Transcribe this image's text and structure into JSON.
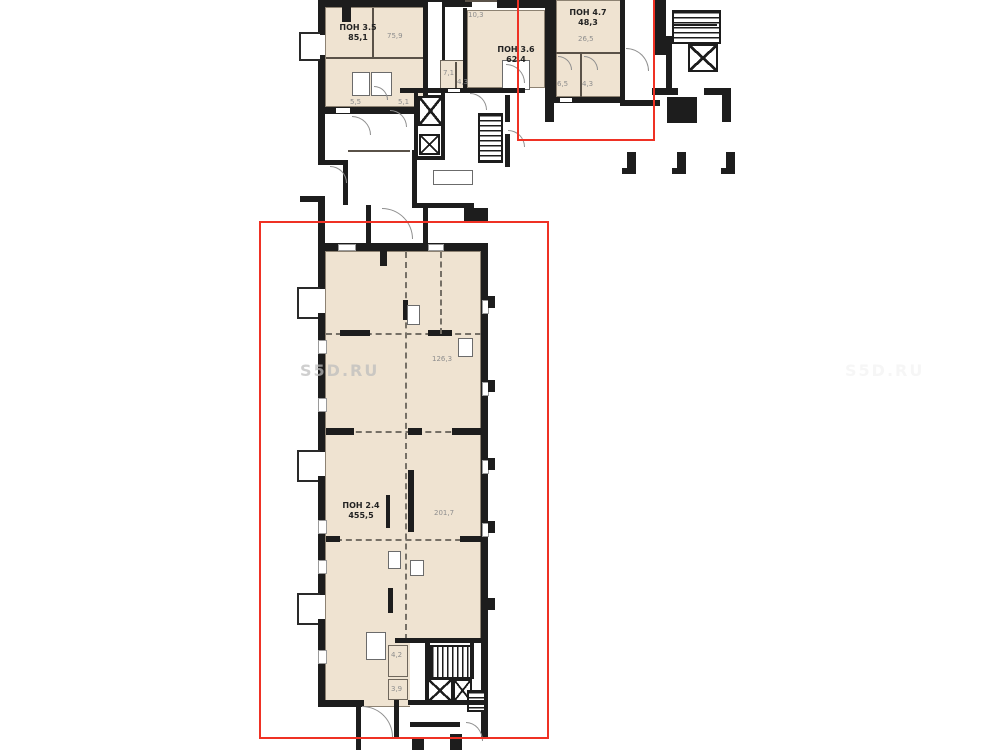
{
  "title": "floor-plan",
  "colors": {
    "room_fill": "#efe3d1",
    "wall": "#1d1d1d",
    "highlight_red": "#ef3124",
    "dim_text": "#8e8e8e",
    "unit_text": "#232323",
    "watermark": "#bdbdbd"
  },
  "watermark": {
    "text": "S5D.RU",
    "text_faint": "S5D.RU"
  },
  "units": [
    {
      "name": "ПОН 3.5",
      "area": "85,1"
    },
    {
      "name": "ПОН 3.6",
      "area": "62,4"
    },
    {
      "name": "ПОН 4.7",
      "area": "48,3"
    },
    {
      "name": "ПОН 2.4",
      "area": "455,5"
    }
  ],
  "dims": [
    {
      "text": "75,9"
    },
    {
      "text": "10,3"
    },
    {
      "text": "5,5"
    },
    {
      "text": "5,1"
    },
    {
      "text": "7,1"
    },
    {
      "text": "4,3"
    },
    {
      "text": "26,5"
    },
    {
      "text": "6,5"
    },
    {
      "text": "4,3"
    },
    {
      "text": "126,3"
    },
    {
      "text": "201,7"
    },
    {
      "text": "4,2"
    },
    {
      "text": "3,9"
    }
  ]
}
